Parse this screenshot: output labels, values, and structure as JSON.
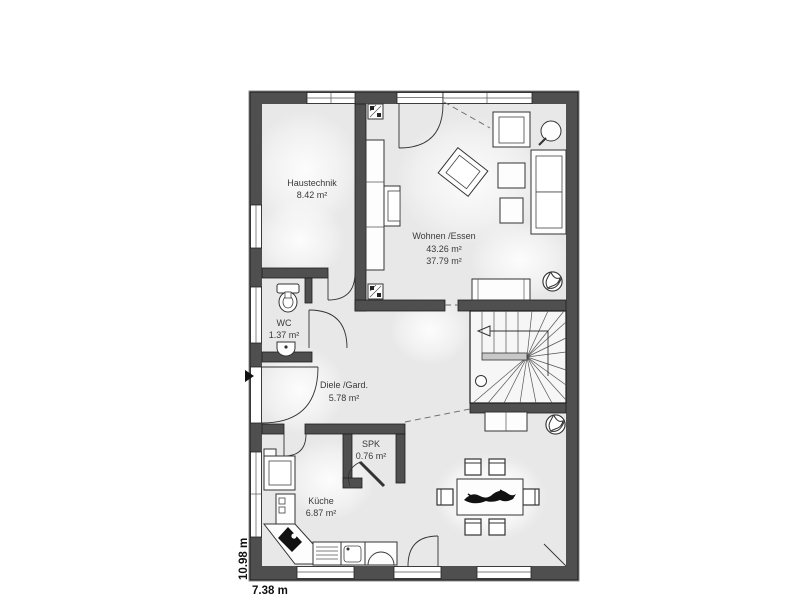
{
  "plan": {
    "type": "floor-plan",
    "rooms": [
      {
        "id": "haustechnik",
        "name": "Haustechnik",
        "area": "8.42 m²"
      },
      {
        "id": "wohnen-essen",
        "name": "Wohnen /Essen",
        "area": "43.26 m²",
        "area2": "37.79 m²"
      },
      {
        "id": "wc",
        "name": "WC",
        "area": "1.37 m²"
      },
      {
        "id": "diele-gard",
        "name": "Diele /Gard.",
        "area": "5.78 m²"
      },
      {
        "id": "spk",
        "name": "SPK",
        "area": "0.76 m²"
      },
      {
        "id": "kueche",
        "name": "Küche",
        "area": "6.87 m²"
      }
    ],
    "dimensions": {
      "width_label": "7.38 m",
      "height_label": "10.98 m"
    },
    "colors": {
      "wall": "#4f4f4f",
      "wall_edge": "#8c8c8c",
      "floor": "#e8e8e8",
      "stair_landing": "#c8c8c8",
      "line": "#333333",
      "background": "#ffffff"
    }
  }
}
